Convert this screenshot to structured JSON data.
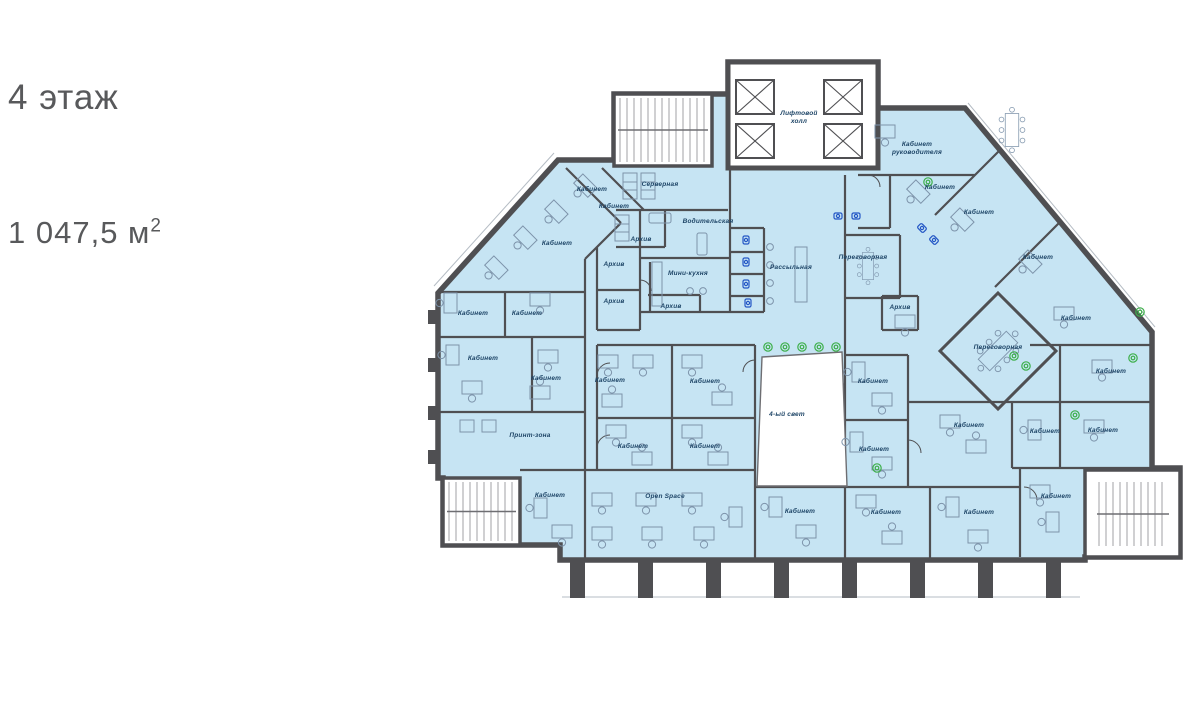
{
  "header": {
    "floor_title": "4 этаж",
    "area_value": "1 047,5 м",
    "area_sup": "2"
  },
  "plan": {
    "colors": {
      "floor_fill": "#c6e4f3",
      "wall": "#4f4f52",
      "furniture": "#7d93aa",
      "label": "#1d4466",
      "plant_green": "#3daf4a",
      "fixture_blue": "#2356c5",
      "title_text": "#58595b"
    },
    "rooms": [
      {
        "label": "Лифтовой\nхолл",
        "x": 799,
        "y": 115
      },
      {
        "label": "Кабинет\nруководителя",
        "x": 917,
        "y": 146
      },
      {
        "label": "Кабинет",
        "x": 940,
        "y": 189
      },
      {
        "label": "Кабинет",
        "x": 979,
        "y": 214
      },
      {
        "label": "Кабинет",
        "x": 1038,
        "y": 259
      },
      {
        "label": "Серверная",
        "x": 660,
        "y": 186
      },
      {
        "label": "Кабинет",
        "x": 592,
        "y": 191
      },
      {
        "label": "Кабинет",
        "x": 614,
        "y": 208
      },
      {
        "label": "Водительская",
        "x": 708,
        "y": 223
      },
      {
        "label": "Кабинет",
        "x": 557,
        "y": 245
      },
      {
        "label": "Архив",
        "x": 641,
        "y": 241
      },
      {
        "label": "Архив",
        "x": 614,
        "y": 266
      },
      {
        "label": "Мини-кухня",
        "x": 688,
        "y": 275
      },
      {
        "label": "Рассыльная",
        "x": 791,
        "y": 269
      },
      {
        "label": "Переговорная",
        "x": 863,
        "y": 259
      },
      {
        "label": "Архив",
        "x": 900,
        "y": 309
      },
      {
        "label": "Архив",
        "x": 614,
        "y": 303
      },
      {
        "label": "Архив",
        "x": 671,
        "y": 308
      },
      {
        "label": "Кабинет",
        "x": 473,
        "y": 315
      },
      {
        "label": "Кабинет",
        "x": 527,
        "y": 315
      },
      {
        "label": "Кабинет",
        "x": 1076,
        "y": 320
      },
      {
        "label": "Переговорная",
        "x": 998,
        "y": 349
      },
      {
        "label": "Кабинет",
        "x": 483,
        "y": 360
      },
      {
        "label": "Кабинет",
        "x": 1111,
        "y": 373
      },
      {
        "label": "Кабинет",
        "x": 546,
        "y": 380
      },
      {
        "label": "Кабинет",
        "x": 610,
        "y": 382
      },
      {
        "label": "Кабинет",
        "x": 705,
        "y": 383
      },
      {
        "label": "Кабинет",
        "x": 873,
        "y": 383
      },
      {
        "label": "4-ый свет",
        "x": 787,
        "y": 416
      },
      {
        "label": "Кабинет",
        "x": 969,
        "y": 427
      },
      {
        "label": "Кабинет",
        "x": 1045,
        "y": 433
      },
      {
        "label": "Кабинет",
        "x": 1103,
        "y": 432
      },
      {
        "label": "Принт-зона",
        "x": 530,
        "y": 437
      },
      {
        "label": "Кабинет",
        "x": 633,
        "y": 448
      },
      {
        "label": "Кабинет",
        "x": 705,
        "y": 448
      },
      {
        "label": "Кабинет",
        "x": 874,
        "y": 451
      },
      {
        "label": "Кабинет",
        "x": 550,
        "y": 497
      },
      {
        "label": "Open Space",
        "x": 665,
        "y": 498
      },
      {
        "label": "Кабинет",
        "x": 1056,
        "y": 498
      },
      {
        "label": "Кабинет",
        "x": 800,
        "y": 513
      },
      {
        "label": "Кабинет",
        "x": 886,
        "y": 514
      },
      {
        "label": "Кабинет",
        "x": 979,
        "y": 514
      }
    ]
  }
}
